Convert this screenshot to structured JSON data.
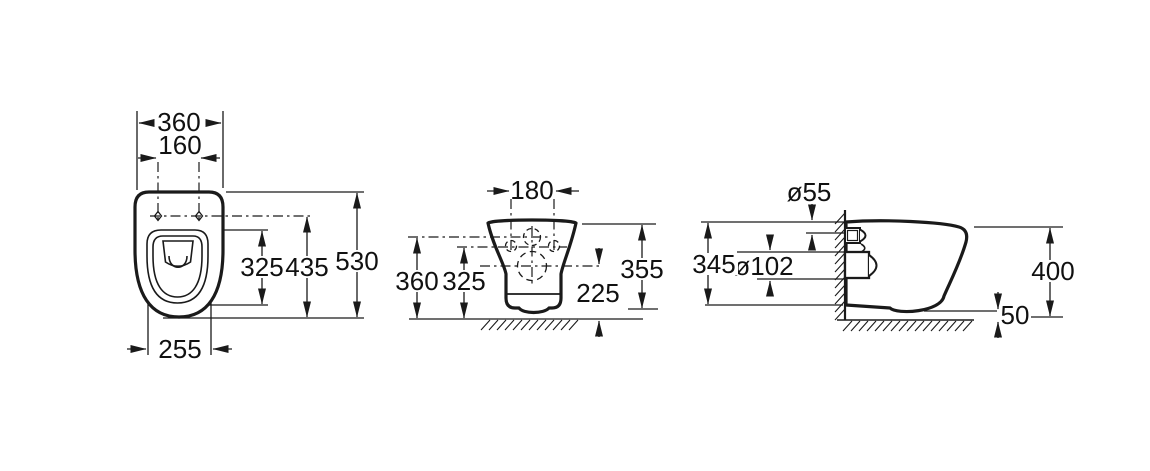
{
  "document": {
    "type": "technical dimension drawing",
    "subject": "wall-hung toilet — three orthographic views",
    "ink_color": "#1a1a1a",
    "background_color": "#ffffff"
  },
  "views": {
    "top": {
      "dims": {
        "overall_width": "360",
        "fixing_centres": "160",
        "bowl_length": "325",
        "axis_to_front": "435",
        "overall_depth": "530",
        "rear_width": "255"
      }
    },
    "front": {
      "dims": {
        "fixing_centres": "180",
        "inlet_axis_height": "360",
        "fixing_axis_height": "325",
        "overall_height": "355",
        "outlet_axis_height": "225"
      }
    },
    "side": {
      "dims": {
        "inlet_diameter": "ø55",
        "wall_height": "345",
        "outlet_diameter": "ø102",
        "rim_height": "400",
        "floor_clearance": "50"
      }
    }
  }
}
